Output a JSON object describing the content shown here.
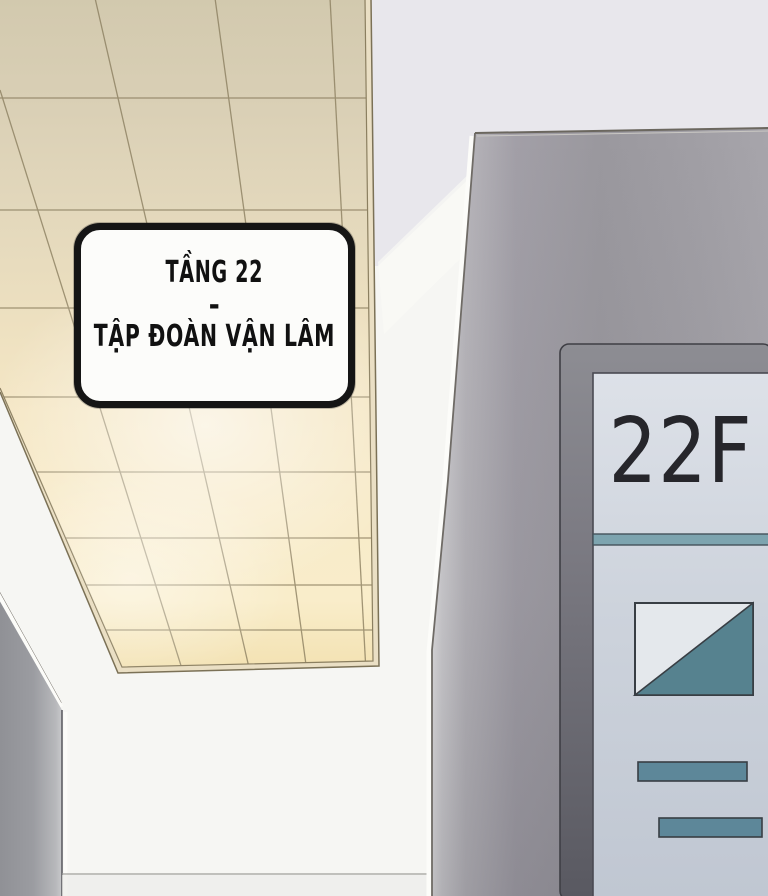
{
  "panel": {
    "caption": {
      "line1": "TẦNG 22",
      "separator": "-",
      "line2": "TẬP ĐOÀN VẬN LÂM"
    },
    "sign": {
      "floor_label": "22F"
    },
    "colors": {
      "ceiling_tan": "#d2c9ae",
      "ceiling_cream": "#f8ebc9",
      "ceiling_trim": "#eadfc4",
      "pillar_gray": "#9b999f",
      "corner_wall_gray": "#97989d",
      "sign_frame": "#6e6d75",
      "sign_panel": "#cdd3dc",
      "teal_divider": "#7da4af",
      "teal_shape": "#56828f",
      "text_dark": "#26262b"
    }
  }
}
